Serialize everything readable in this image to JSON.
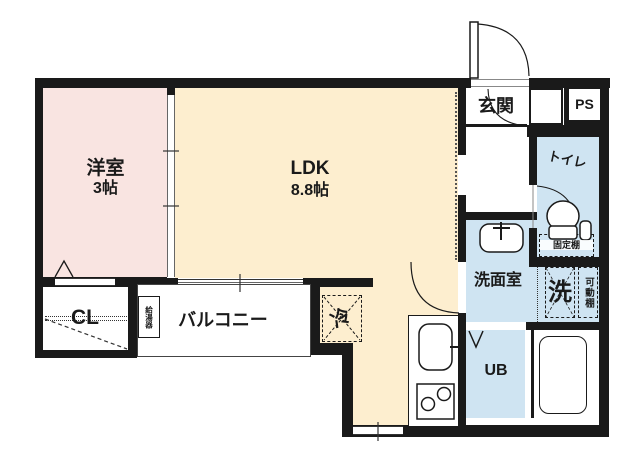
{
  "plan": {
    "type": "apartment-floorplan",
    "colors": {
      "wall": "#1a1a1a",
      "western_room": "#f9e4e1",
      "ldk": "#fdeecf",
      "wet_area": "#cfe4f2",
      "floor_white": "#ffffff"
    },
    "rooms": {
      "western": {
        "name": "洋室",
        "size": "3帖"
      },
      "ldk": {
        "name": "LDK",
        "size": "8.8帖"
      },
      "entrance": {
        "name": "玄関"
      },
      "ps": {
        "name": "PS"
      },
      "toilet": {
        "name": "トイレ"
      },
      "washroom": {
        "name": "洗面室"
      },
      "unit_bath": {
        "name": "UB"
      },
      "closet": {
        "name": "CL"
      },
      "balcony": {
        "name": "バルコニー"
      }
    },
    "fixtures": {
      "water_heater": "給湯器",
      "refrigerator": "冷",
      "washer_space": "洗",
      "movable_shelf": "可動棚",
      "fixed_shelf": "固定棚"
    }
  }
}
